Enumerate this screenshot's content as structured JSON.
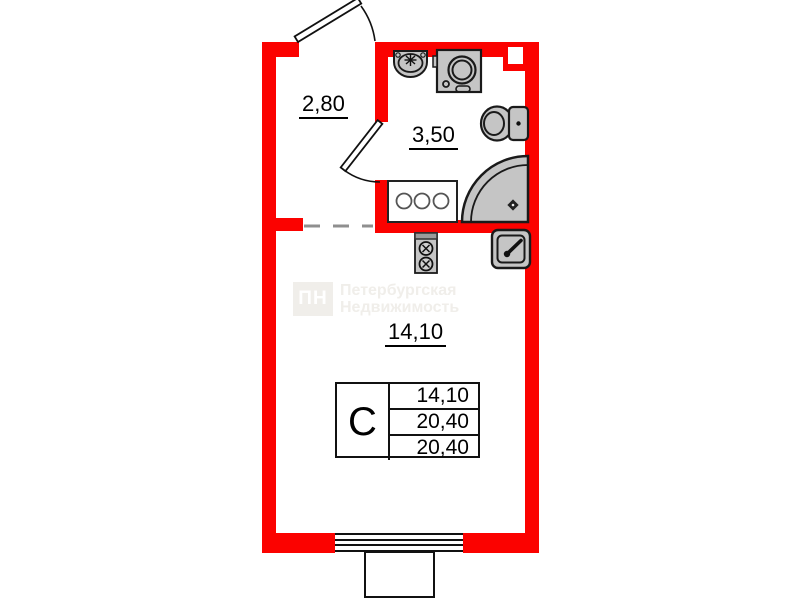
{
  "plan": {
    "rooms": {
      "hallway": {
        "area_label": "2,80"
      },
      "bathroom": {
        "area_label": "3,50"
      },
      "living_room": {
        "area_label": "14,10"
      }
    },
    "info_table": {
      "type_label": "С",
      "values": [
        "14,10",
        "20,40",
        "20,40"
      ]
    },
    "watermark": {
      "logo_text": "ПН",
      "line1": "Петербургская",
      "line2": "Недвижимость"
    },
    "colors": {
      "wall_red": "#fb0200",
      "fixture_gray": "#c5c5c5",
      "fixture_outline": "#1a1a1a",
      "divider_dash_gray": "#8f8f8f",
      "watermark_gray": "#f0eeea"
    },
    "fixtures": [
      "entrance-door",
      "bathroom-door",
      "bathroom-sink",
      "washing-machine",
      "toilet",
      "corner-shower",
      "cooktop-counter",
      "stove-unit",
      "kitchen-sink",
      "vent-shaft",
      "window",
      "balcony"
    ]
  }
}
